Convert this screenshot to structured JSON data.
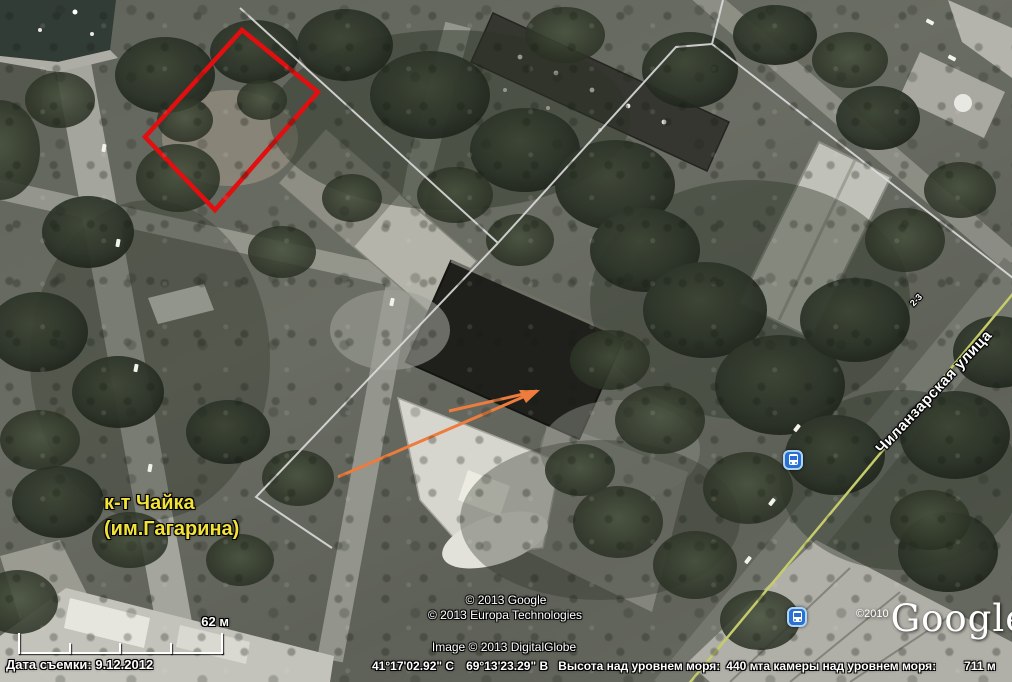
{
  "map": {
    "place_label_line1": "к-т Чайка",
    "place_label_line2": "(им.Гагарина)",
    "street_label": "Чиланзарская улица",
    "house_label": "2-3",
    "scale_label": "62 м",
    "copyright_google": "© 2013 Google",
    "copyright_europa": "© 2013 Europa Technologies",
    "copyright_image": "Image © 2013 DigitalGlobe",
    "logo_year": "©2010",
    "logo_text": "Google",
    "logo_tm": "™"
  },
  "status_bar": {
    "date": "Дата съемки: 9.12.2012",
    "latitude": "41°17'02.92\" С",
    "longitude": "69°13'23.29\" В",
    "elevation_label": "Высота над уровнем моря:",
    "elevation_value": "440 м",
    "camera_label": "та камеры над уровнем моря:",
    "camera_value": "711 м"
  },
  "icons": {
    "bus_stop": "bus-stop-icon"
  },
  "colors": {
    "annotation_red": "#e10f0f",
    "arrow_orange": "#ee7c3c",
    "label_yellow": "#f2e23a",
    "road_centerline_yellow": "#c6cc69",
    "boundary_gray": "#dcdcdc",
    "bus_icon_blue": "#2a6fd4"
  }
}
